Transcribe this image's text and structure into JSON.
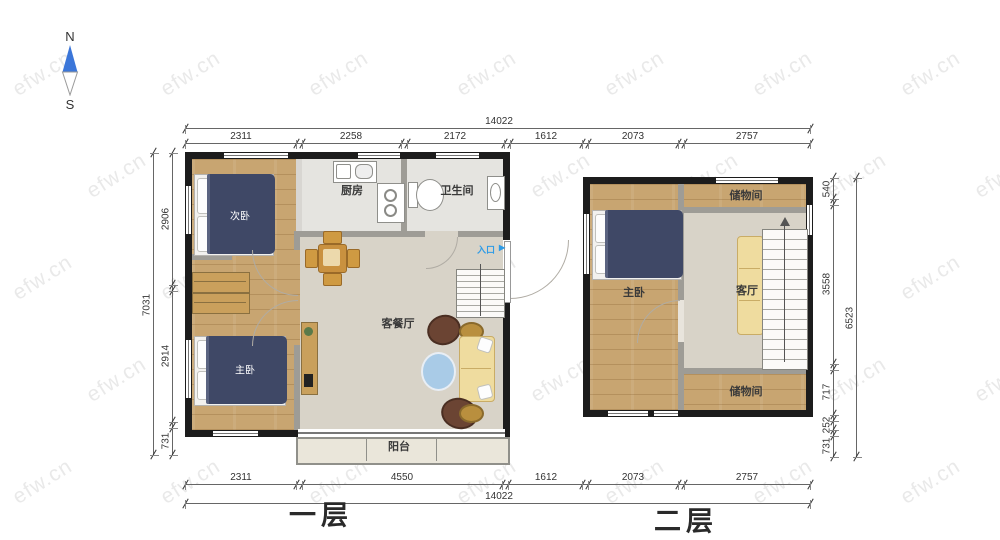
{
  "watermark": "efw.cn",
  "compass": {
    "north_label": "N",
    "south_label": "S"
  },
  "icons": {
    "entrance_arrow": "▶",
    "stairs_up_arrow": "▲"
  },
  "floor1": {
    "title": "一层",
    "labels": {
      "secondary_bedroom": "次卧",
      "kitchen": "厨房",
      "bathroom": "卫生间",
      "living_dining": "客餐厅",
      "master_bedroom": "主卧",
      "balcony": "阳台",
      "entrance": "入口"
    }
  },
  "floor2": {
    "title": "二层",
    "labels": {
      "master_bedroom": "主卧",
      "storage_top": "储物间",
      "living": "客厅",
      "storage_bottom": "储物间"
    }
  },
  "dims": {
    "top_total": "14022",
    "top_segments": [
      "2311",
      "2258",
      "2172",
      "1612",
      "2073",
      "2757"
    ],
    "bottom_total": "14022",
    "bottom_segments": [
      "2311",
      "4550",
      "1612",
      "2073",
      "2757"
    ],
    "left_total": "7031",
    "left_segments": [
      "2906",
      "2914",
      "731"
    ],
    "right_total": "6523",
    "right_segments": [
      "540",
      "3558",
      "717",
      "252",
      "731"
    ]
  },
  "colors": {
    "wall": "#1c1c1c",
    "wood_floor": "#c8a571",
    "living_floor": "#d8d3c8",
    "bed": "#3f4866",
    "sofa": "#efdc9f",
    "accent_blue": "#2e9be6",
    "compass_blue": "#3b76d9"
  }
}
